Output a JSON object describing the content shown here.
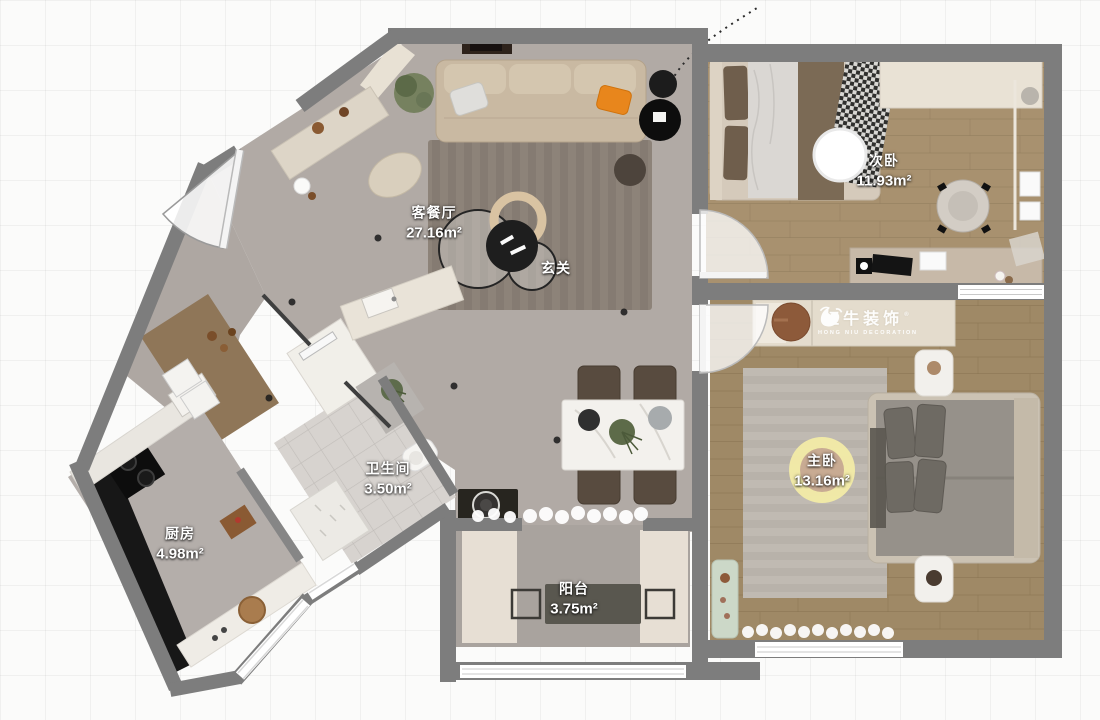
{
  "rooms": [
    {
      "id": "living_dining",
      "label": "客餐厅",
      "area": "27.16m²"
    },
    {
      "id": "entry",
      "label": "玄关",
      "area": ""
    },
    {
      "id": "bedroom_second",
      "label": "次卧",
      "area": "11.93m²"
    },
    {
      "id": "bedroom_master",
      "label": "主卧",
      "area": "13.16m²"
    },
    {
      "id": "bathroom",
      "label": "卫生间",
      "area": "3.50m²"
    },
    {
      "id": "kitchen",
      "label": "厨房",
      "area": "4.98m²"
    },
    {
      "id": "balcony",
      "label": "阳台",
      "area": "3.75m²"
    }
  ],
  "watermark": {
    "brand": "红牛装饰",
    "subtitle": "HONG NIU DECORATION",
    "registered": "®"
  },
  "colors": {
    "wall": "#7d7d7d",
    "floor_concrete": "#b1aaa5",
    "floor_wood_second": "#a8916f",
    "floor_wood_master": "#9f8966",
    "bath_tile": "#d7d3cf",
    "banner": "#e4dccd",
    "accent_orange": "#e8861c",
    "lamp_halo": "#f2eba6",
    "label_text": "#ffffff",
    "watermark_text": "#ffffff"
  }
}
